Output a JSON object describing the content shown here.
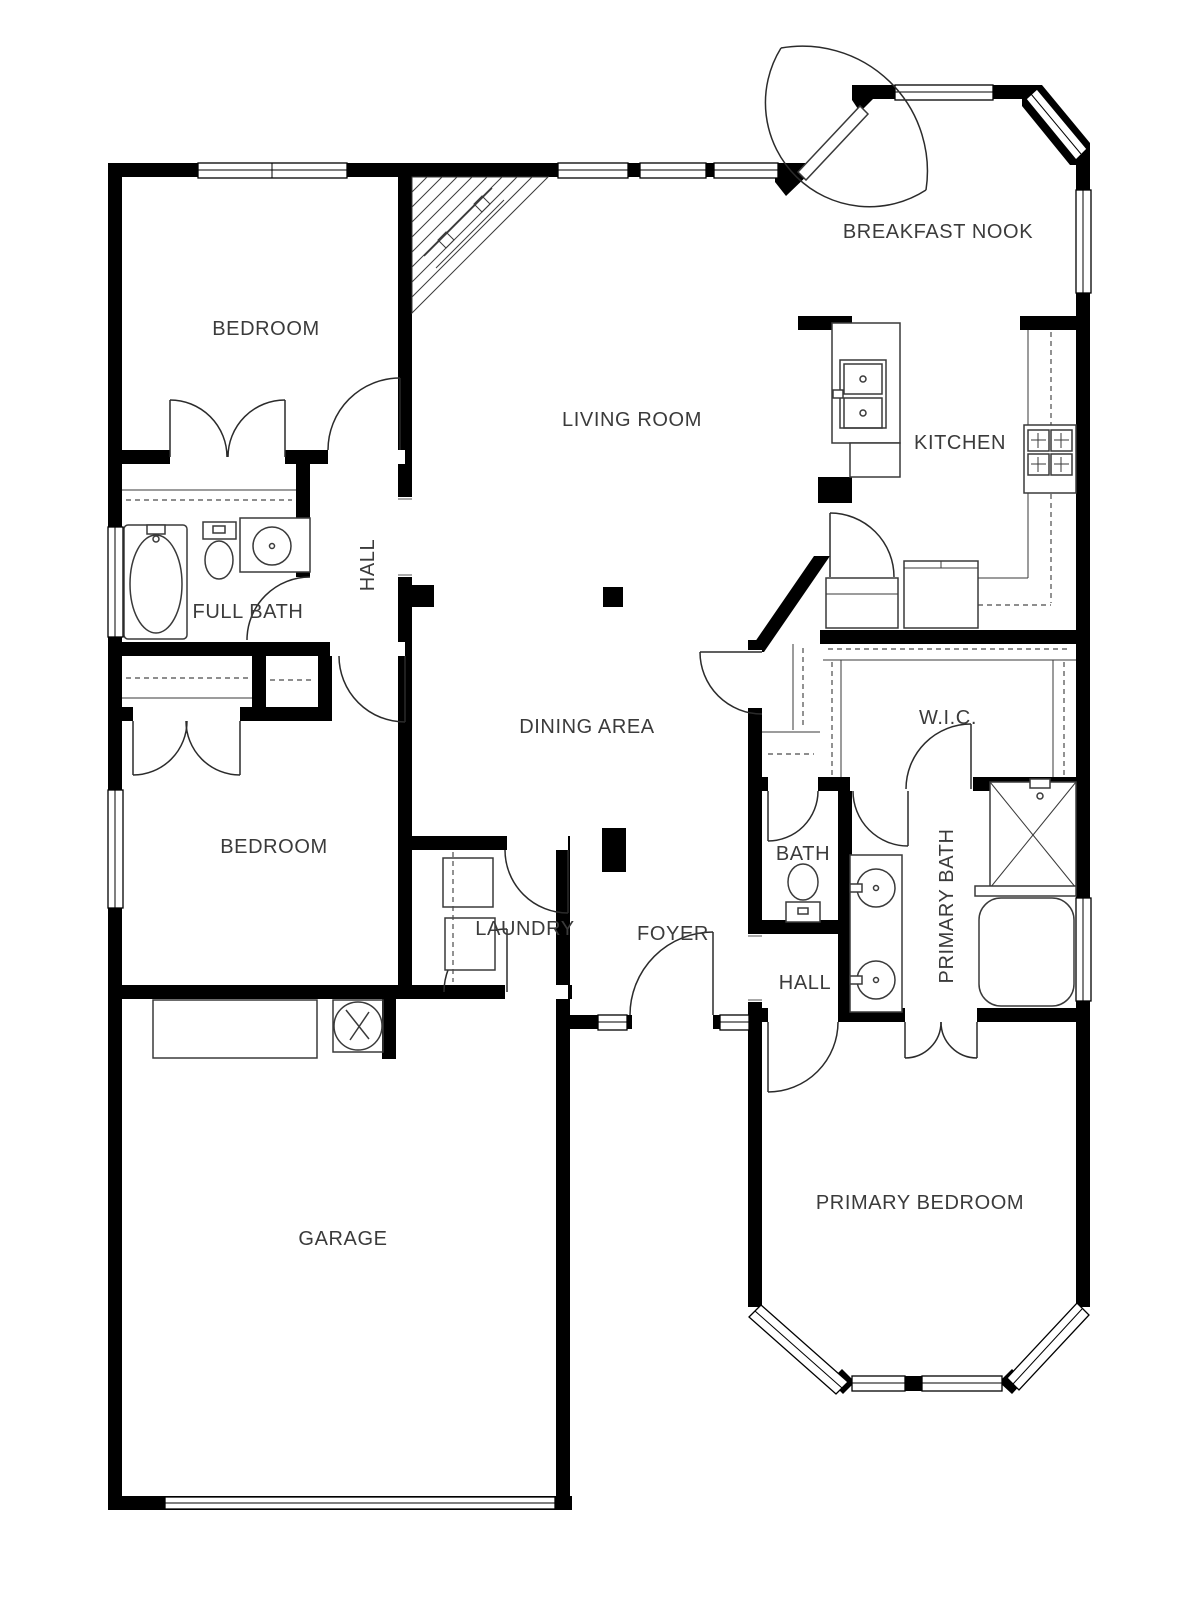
{
  "title": "Single-story house floor plan",
  "colors": {
    "wall": "#000000",
    "line": "#3a3a3a",
    "label": "#3b3b3b",
    "bg": "#ffffff"
  },
  "rooms": [
    {
      "id": "breakfast-nook",
      "label": "BREAKFAST NOOK"
    },
    {
      "id": "bedroom-north",
      "label": "BEDROOM"
    },
    {
      "id": "living-room",
      "label": "LIVING ROOM"
    },
    {
      "id": "kitchen",
      "label": "KITCHEN"
    },
    {
      "id": "hall-north",
      "label": "HALL"
    },
    {
      "id": "full-bath",
      "label": "FULL BATH"
    },
    {
      "id": "dining-area",
      "label": "DINING AREA"
    },
    {
      "id": "wic",
      "label": "W.I.C."
    },
    {
      "id": "bedroom-west",
      "label": "BEDROOM"
    },
    {
      "id": "bath",
      "label": "BATH"
    },
    {
      "id": "primary-bath",
      "label": "PRIMARY BATH"
    },
    {
      "id": "laundry",
      "label": "LAUNDRY"
    },
    {
      "id": "foyer",
      "label": "FOYER"
    },
    {
      "id": "hall-primary",
      "label": "HALL"
    },
    {
      "id": "primary-bedroom",
      "label": "PRIMARY BEDROOM"
    },
    {
      "id": "garage",
      "label": "GARAGE"
    }
  ]
}
